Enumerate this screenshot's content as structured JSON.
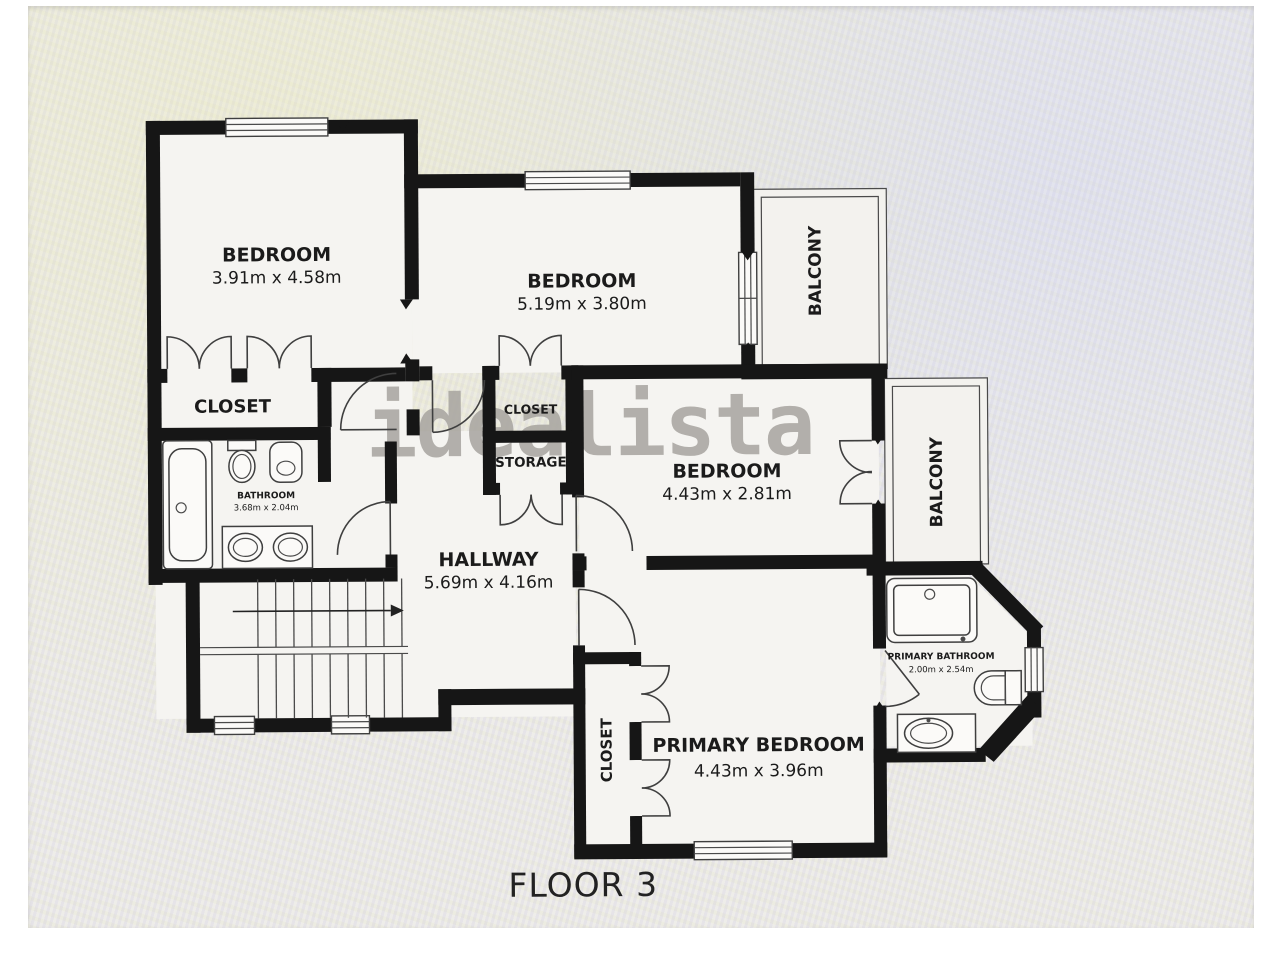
{
  "floorplan": {
    "caption": "FLOOR 3",
    "watermark": "idealista",
    "rooms": [
      {
        "name": "BEDROOM",
        "dims": "3.91m x 4.58m"
      },
      {
        "name": "BEDROOM",
        "dims": "5.19m x 3.80m"
      },
      {
        "name": "BEDROOM",
        "dims": "4.43m x 2.81m"
      },
      {
        "name": "PRIMARY BEDROOM",
        "dims": "4.43m x 3.96m"
      },
      {
        "name": "HALLWAY",
        "dims": "5.69m x 4.16m"
      },
      {
        "name": "BATHROOM",
        "dims": "3.68m x 2.04m"
      },
      {
        "name": "PRIMARY BATHROOM",
        "dims": "2.00m x 2.54m"
      },
      {
        "name": "BALCONY"
      },
      {
        "name": "BALCONY"
      },
      {
        "name": "CLOSET"
      },
      {
        "name": "CLOSET"
      },
      {
        "name": "STORAGE"
      },
      {
        "name": "CLOSET"
      }
    ],
    "colors": {
      "wall": "#161616",
      "floor": "#f5f4f1",
      "photo_background": "#ebeae7",
      "text": "#1b1b1b",
      "watermark": "#a7a49f"
    }
  }
}
